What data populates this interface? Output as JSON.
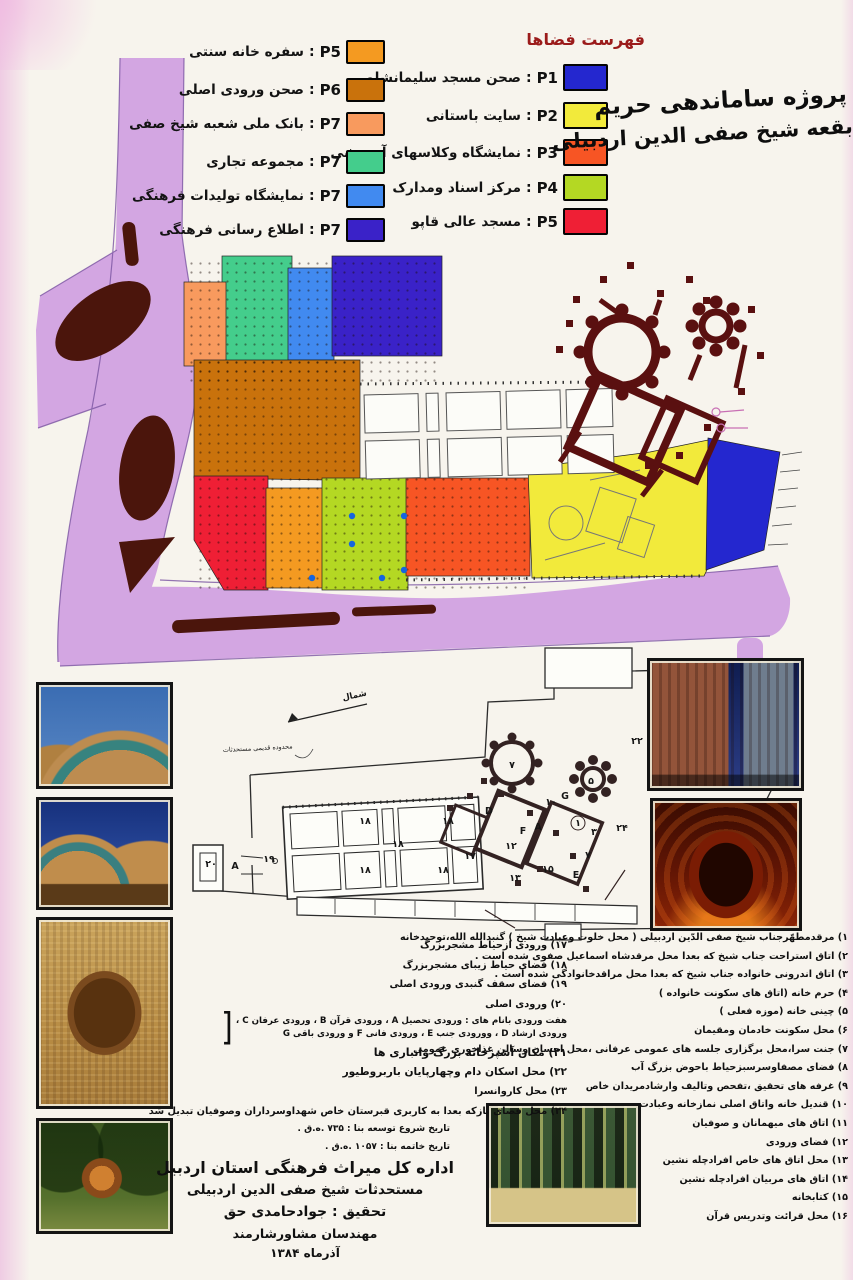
{
  "page": {
    "title_line1": "پروژه ساماندهی حریم",
    "title_line2": "بقعه شیخ صفی الدین اردبیلی"
  },
  "ui": {
    "sep": ":"
  },
  "legend_right": {
    "header": "فهرست فضاها",
    "header_color": "#9b1b1b",
    "items": [
      {
        "code": "P1",
        "label": "صحن مسجد سلیمانشاه",
        "color": "#2427cf"
      },
      {
        "code": "P2",
        "label": "سایت باستانی",
        "color": "#f2ea3b"
      },
      {
        "code": "P3",
        "label": "نمایشگاه وکلاسهای آموزشی",
        "color": "#f75524"
      },
      {
        "code": "P4",
        "label": "مرکز اسناد ومدارک",
        "color": "#b4d823"
      },
      {
        "code": "P5",
        "label": "مسجد عالی قاپو",
        "color": "#ef1f35"
      }
    ]
  },
  "legend_left": {
    "items": [
      {
        "code": "P5",
        "label": "سفره خانه سنتی",
        "color": "#f49a21"
      },
      {
        "code": "P6",
        "label": "صحن ورودی اصلی",
        "color": "#c9720c"
      },
      {
        "code": "P7",
        "label": "بانک ملی شعبه شیخ صفی",
        "color": "#f89a5e"
      },
      {
        "code": "P7",
        "label": "مجموعه تجاری",
        "color": "#44cd8c"
      },
      {
        "code": "P7",
        "label": "نمایشگاه تولیدات فرهنگی",
        "color": "#418af0"
      },
      {
        "code": "P7",
        "label": "اطلاع رسانی فرهنگی",
        "color": "#3a22c8"
      }
    ]
  },
  "site_plan": {
    "road_color": "#d3a6e2",
    "road_edge_color": "#7b55a2",
    "median_color": "#4b150c",
    "shrine_color": "#5a1010",
    "pool_color": "#1565e0"
  },
  "bottom_plan": {
    "north_label": "شمال",
    "boundary_label": "محدوده قدیمی مستحدثات",
    "labels": [
      {
        "t": "۲۱",
        "x": 538,
        "y": 80
      },
      {
        "t": "۲۲",
        "x": 452,
        "y": 104
      },
      {
        "t": "۷",
        "x": 327,
        "y": 128
      },
      {
        "t": "۵",
        "x": 406,
        "y": 144
      },
      {
        "t": "G",
        "x": 380,
        "y": 159
      },
      {
        "t": "۱۰",
        "x": 366,
        "y": 165
      },
      {
        "t": "D",
        "x": 304,
        "y": 174
      },
      {
        "t": "F",
        "x": 338,
        "y": 194
      },
      {
        "t": "A",
        "x": 353,
        "y": 190
      },
      {
        "t": "۳",
        "x": 409,
        "y": 195
      },
      {
        "t": "۱",
        "x": 393,
        "y": 186
      },
      {
        "t": "۱۲",
        "x": 326,
        "y": 209
      },
      {
        "t": "۱۷",
        "x": 285,
        "y": 219
      },
      {
        "t": "۱۳",
        "x": 330,
        "y": 241
      },
      {
        "t": "۱۵",
        "x": 363,
        "y": 232
      },
      {
        "t": "E",
        "x": 391,
        "y": 238
      },
      {
        "t": "۷",
        "x": 403,
        "y": 218
      },
      {
        "t": "۲۴",
        "x": 437,
        "y": 191
      },
      {
        "t": "۱۸",
        "x": 180,
        "y": 184
      },
      {
        "t": "۱۸",
        "x": 263,
        "y": 184
      },
      {
        "t": "۱۸",
        "x": 213,
        "y": 207
      },
      {
        "t": "۱۸",
        "x": 180,
        "y": 233
      },
      {
        "t": "۱۸",
        "x": 258,
        "y": 233
      },
      {
        "t": "۱۹",
        "x": 84,
        "y": 222
      },
      {
        "t": "۲۰",
        "x": 26,
        "y": 227
      },
      {
        "t": "A",
        "x": 50,
        "y": 229
      }
    ]
  },
  "notes_right": {
    "items": [
      "۱) مرقدمطهّرجناب شیخ صفی الدّین اردبیلی ( محل خلوت وعبادت شیخ ) گنبدالله الله،توحیدخانه",
      "۲) اتاق استراحت جناب شیخ که بعدا محل مرقدشاه اسماعیل صفوی شده است .",
      "۳) اتاق اندرونی خانواده جناب شیخ که بعدا محل مراقدخانوادگی شده است .",
      "۴) حرم خانه (اتاق های سکونت خانواده )",
      "۵) چینی خانه (موزه فعلی )",
      "۶) محل سکونت خادمان ومقیمان",
      "۷) جنت سرا،محل برگزاری جلسه های عمومی عرفانی ،محل احسان وسالن غذاخوری عمومی",
      "۸) فضای مصفاوسرسبزحیاط باحوض بزرگ آب",
      "۹) غرفه های تحقیق ،تفحص وتالیف وارشادمریدان خاص",
      "۱۰) قندیل خانه واتاق اصلی نمازخانه وعبادت",
      "۱۱) اتاق های میهمانان و صوفیان",
      "۱۲) فضای ورودی",
      "۱۳) محل اتاق های خاص افرادچله نشین",
      "۱۴) اتاق های مربیان افرادچله نشین",
      "۱۵) کتابخانه",
      "۱۶) محل قرائت وتدریس قرآن"
    ]
  },
  "notes_left": {
    "items_a": [
      "۱۷) ورودی ازحیاط مشجربزرگ",
      "۱۸) فضای حیاط زیبای مشجربزرگ",
      "۱۹) فضای سقف گنبدی ورودی اصلی",
      "۲۰) ورودی اصلی"
    ],
    "bracket_line1": "هفت ورودی بانام های : ورودی تحصیل A ، ورودی قرآن B ، ورودی عرفان C ،",
    "bracket_line2": "ورودی ارشاد D ، وورودی جنب E ، ورودی فانی F و ورودی باقی G",
    "items_b": [
      "۲۱) مکان آشپزخانه بزرگ وانباری ها",
      "۲۲) محل اسکان دام وچهارپایان باربروطیور",
      "۲۳) محل کاروانسرا",
      "۲۴) محل فضای بازکه بعدا به کاربری قبرستان خاص شهداوسرداران وصوفیان تبدیل شد"
    ]
  },
  "credits": {
    "date1": "تاریخ شروع توسعه بنا : ۷۳۵ .ه.ق .",
    "date2": "تاریخ خاتمه بنا : ۱۰۵۷ .ه.ق .",
    "org": "اداره کل میراث فرهنگی استان اردبیل",
    "subject": "مستحدثات شیخ صفی الدین اردبیلی",
    "research": "تحقیق : جوادحامدی حق",
    "consultant": "مهندسان مشاورشارمند",
    "date3": "آذرماه ۱۳۸۴"
  }
}
